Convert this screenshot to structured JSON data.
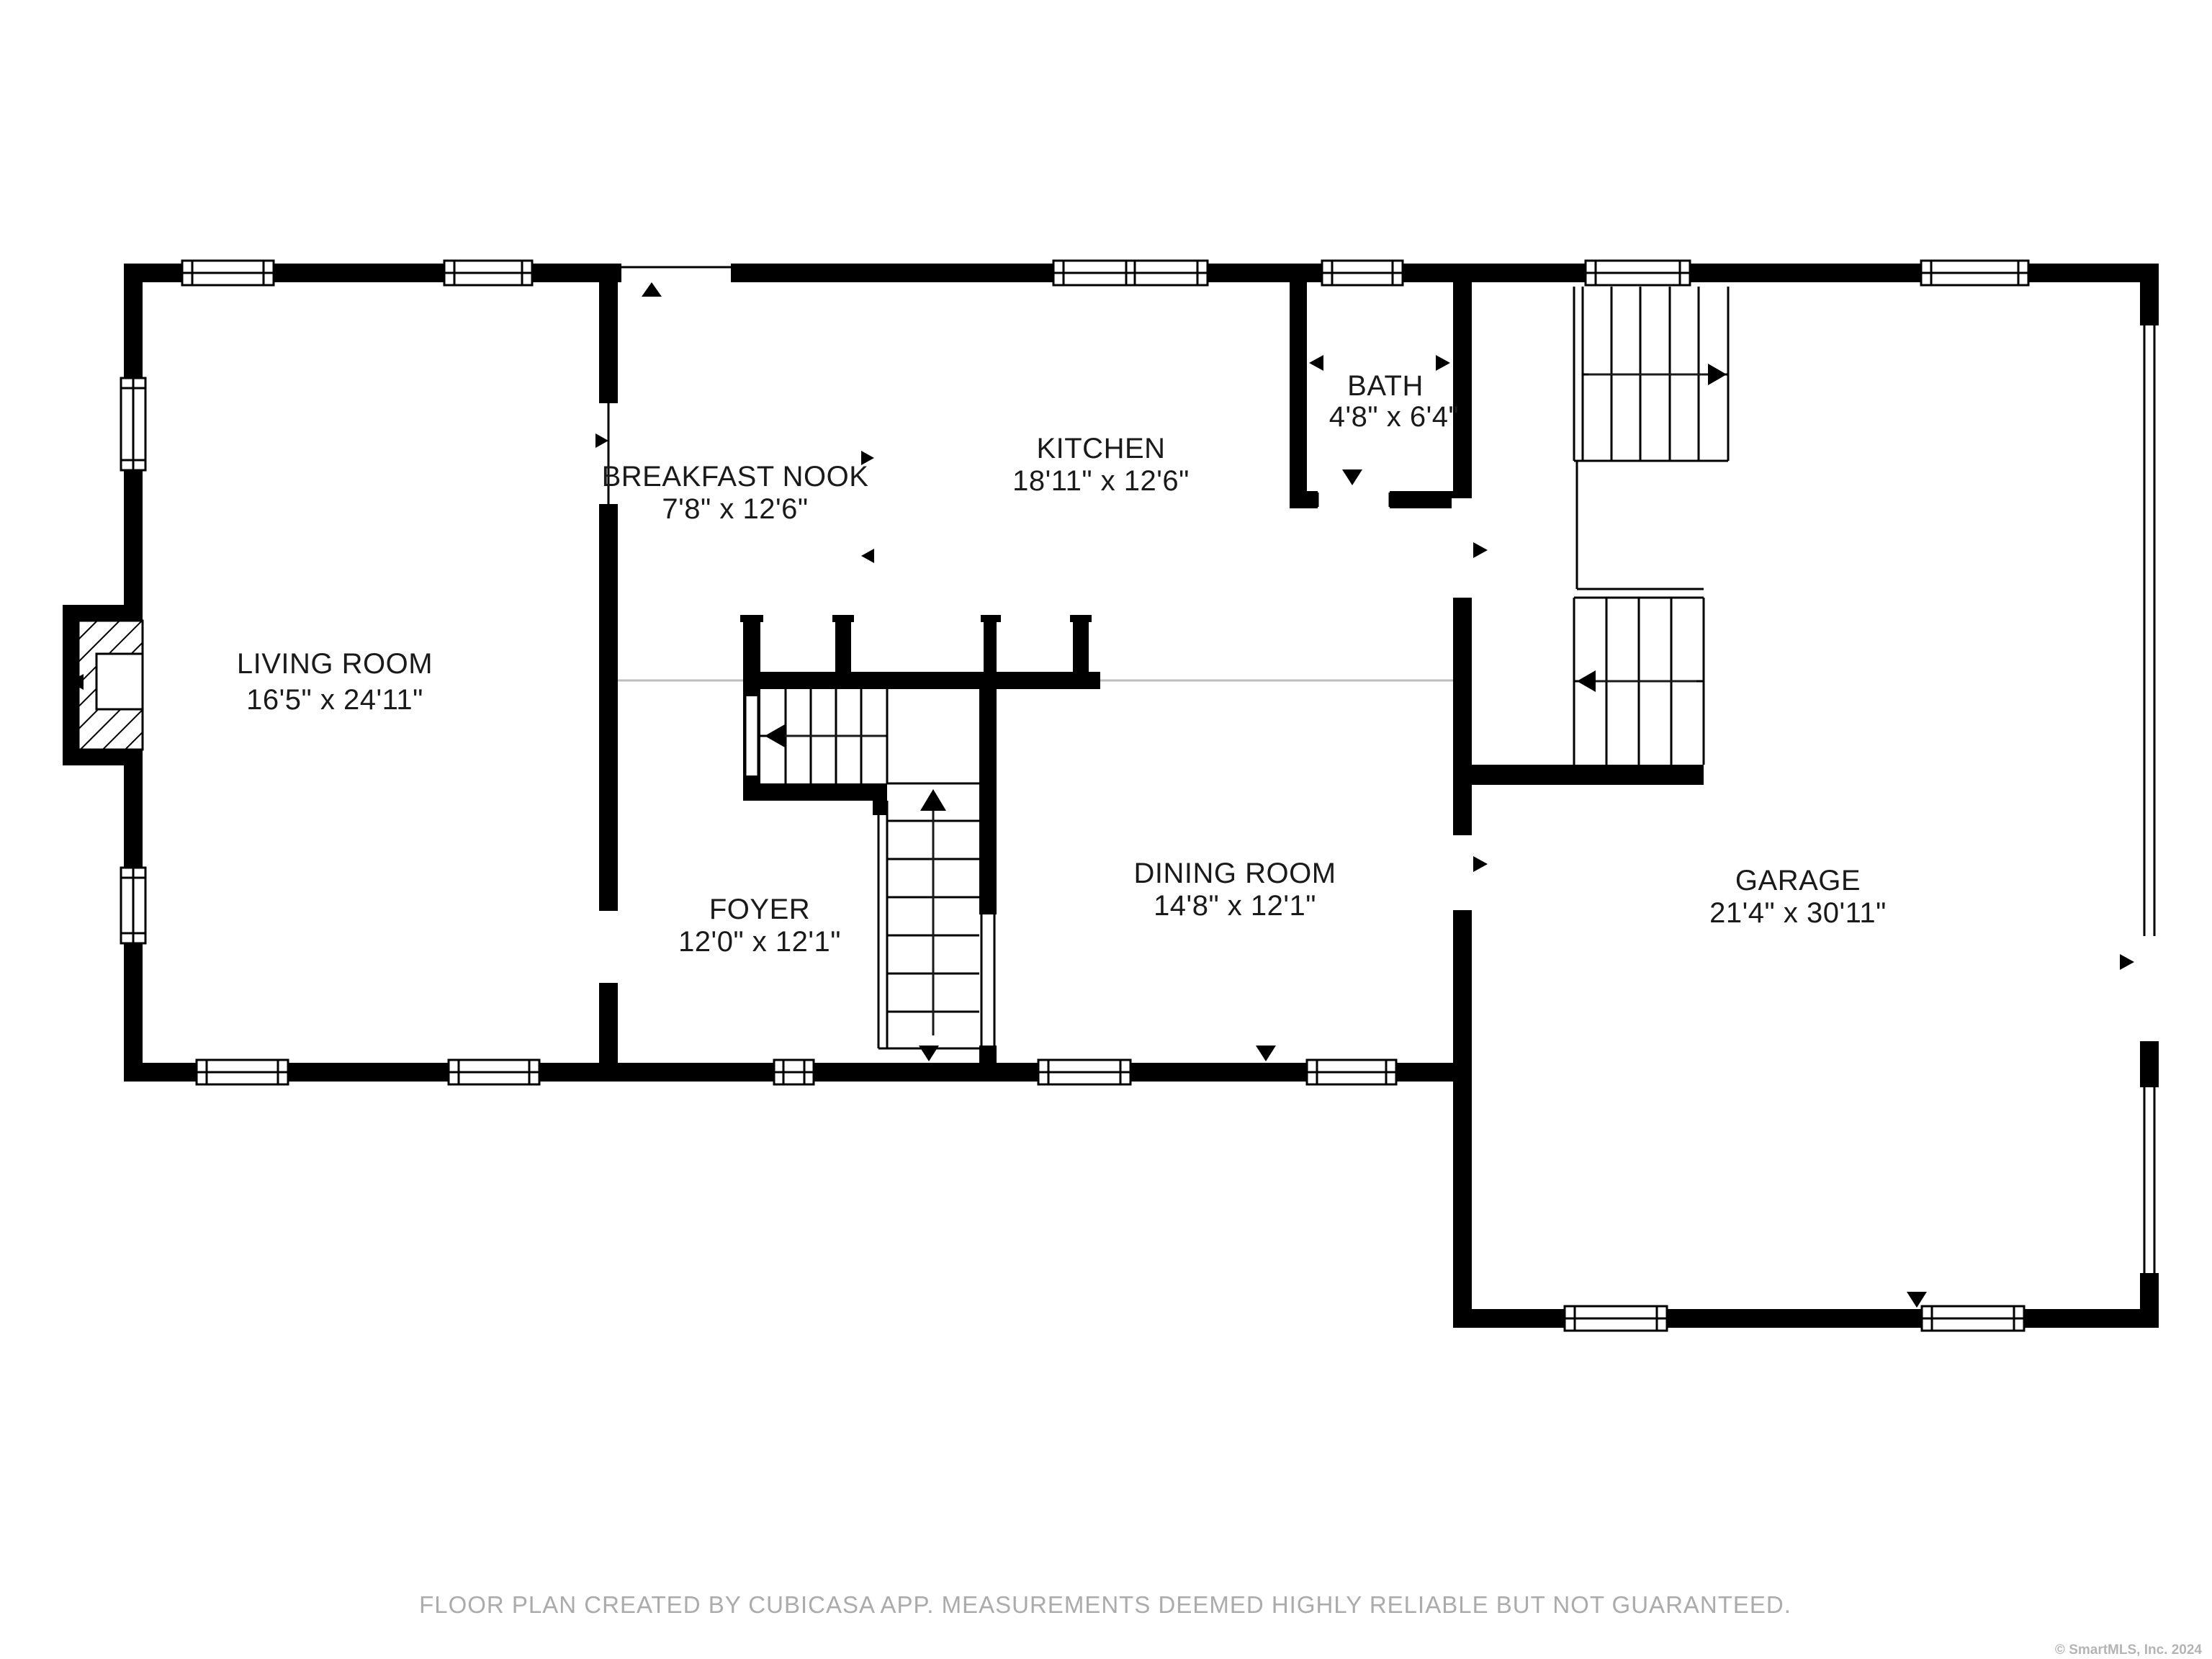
{
  "document": {
    "type": "floor-plan",
    "creator_note": "FLOOR PLAN CREATED BY CUBICASA APP. MEASUREMENTS DEEMED HIGHLY RELIABLE BUT NOT GUARANTEED.",
    "copyright": "© SmartMLS, Inc. 2024"
  },
  "rooms": [
    {
      "id": "living-room",
      "name": "LIVING ROOM",
      "dimensions": "16'5\" x 24'11\""
    },
    {
      "id": "breakfast-nook",
      "name": "BREAKFAST NOOK",
      "dimensions": "7'8\" x 12'6\""
    },
    {
      "id": "kitchen",
      "name": "KITCHEN",
      "dimensions": "18'11\" x 12'6\""
    },
    {
      "id": "bath",
      "name": "BATH",
      "dimensions": "4'8\" x 6'4\""
    },
    {
      "id": "foyer",
      "name": "FOYER",
      "dimensions": "12'0\" x 12'1\""
    },
    {
      "id": "dining-room",
      "name": "DINING ROOM",
      "dimensions": "14'8\" x 12'1\""
    },
    {
      "id": "garage",
      "name": "GARAGE",
      "dimensions": "21'4\" x 30'11\""
    }
  ],
  "features": {
    "stairs": [
      "foyer-l-shaped-staircase",
      "garage-switchback-staircase"
    ],
    "fireplace": "living-room-west-wall",
    "window_count": 15,
    "door_markers": 12
  },
  "colors": {
    "wall": "#000000",
    "background": "#ffffff",
    "label": "#1a1a1a",
    "open_divider": "#bdbdbd",
    "footer": "#ababab",
    "copyright": "#b4b4b4"
  }
}
